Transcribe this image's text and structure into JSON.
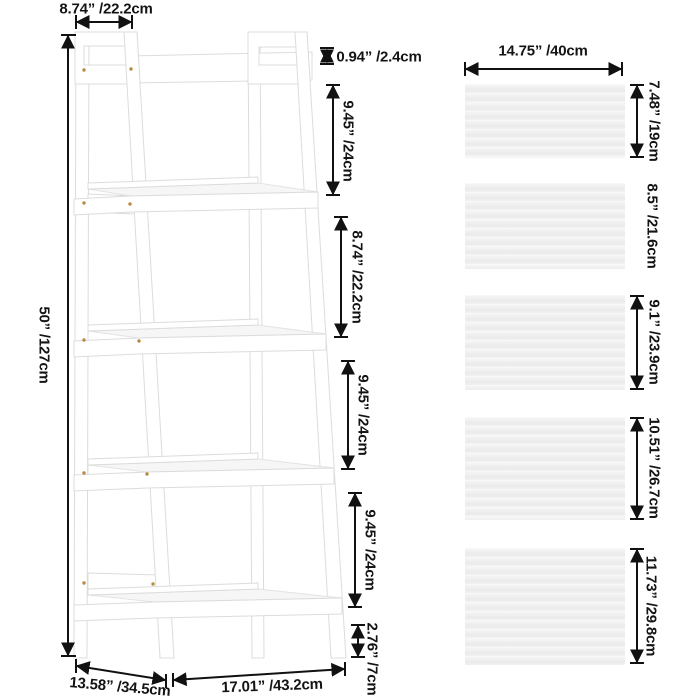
{
  "diagram": {
    "type": "product-dimension-diagram",
    "subject": "5-tier ladder shelf",
    "shelf": {
      "top_width": "8.74” /22.2cm",
      "overall_height": "50” /127cm",
      "top_edge_thickness": "0.94” /2.4cm",
      "tier_gaps": [
        "9.45” /24cm",
        "8.74” /22.2cm",
        "9.45” /24cm",
        "9.45” /24cm"
      ],
      "foot_height": "2.76” /7cm",
      "base_depth": "13.58” /34.5cm",
      "base_width": "17.01” /43.2cm"
    },
    "boards": {
      "width_label": "14.75” /40cm",
      "items": [
        {
          "name": "board-1",
          "height_label": "7.48” /19cm"
        },
        {
          "name": "board-2",
          "height_label": "8.5” /21.6cm"
        },
        {
          "name": "board-3",
          "height_label": "9.1” /23.9cm"
        },
        {
          "name": "board-4",
          "height_label": "10.51” /26.7cm"
        },
        {
          "name": "board-5",
          "height_label": "11.73” /29.8cm"
        }
      ]
    },
    "colors": {
      "background": "#ffffff",
      "text": "#141414",
      "arrow": "#111111",
      "shelf_fill": "#ffffff",
      "shelf_outline": "#dcdcdc",
      "board_fill": "#f1f1f1",
      "screw": "#b5853a"
    }
  }
}
